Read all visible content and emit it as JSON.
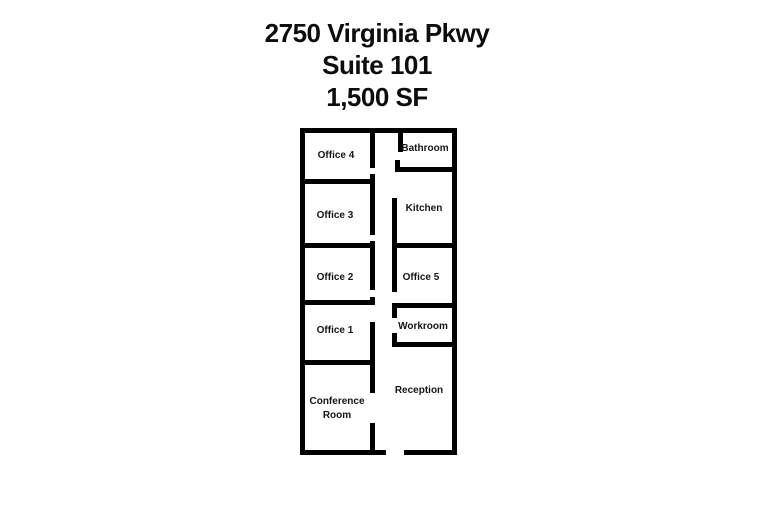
{
  "title": {
    "address": "2750 Virginia Pkwy",
    "suite": "Suite 101",
    "area": "1,500 SF"
  },
  "colors": {
    "wall": "#000000",
    "label_text": "#161616",
    "background": "#ffffff"
  },
  "floorplan": {
    "rooms": [
      {
        "name": "office-4",
        "label": "Office 4",
        "cx": 336,
        "cy": 156
      },
      {
        "name": "bathroom",
        "label": "Bathroom",
        "cx": 425,
        "cy": 149
      },
      {
        "name": "office-3",
        "label": "Office 3",
        "cx": 335,
        "cy": 216
      },
      {
        "name": "kitchen",
        "label": "Kitchen",
        "cx": 424,
        "cy": 209
      },
      {
        "name": "office-2",
        "label": "Office 2",
        "cx": 335,
        "cy": 278
      },
      {
        "name": "office-5",
        "label": "Office 5",
        "cx": 421,
        "cy": 278
      },
      {
        "name": "office-1",
        "label": "Office 1",
        "cx": 335,
        "cy": 331
      },
      {
        "name": "workroom",
        "label": "Workroom",
        "cx": 423,
        "cy": 327
      },
      {
        "name": "conference-room",
        "label": "Conference Room",
        "cx": 337,
        "cy": 409,
        "wrap_width": 70
      },
      {
        "name": "reception",
        "label": "Reception",
        "cx": 419,
        "cy": 391
      }
    ],
    "walls": [
      {
        "name": "outer-top",
        "x": 300,
        "y": 128,
        "w": 157,
        "h": 5
      },
      {
        "name": "outer-left",
        "x": 300,
        "y": 128,
        "w": 5,
        "h": 327
      },
      {
        "name": "outer-right",
        "x": 452,
        "y": 128,
        "w": 5,
        "h": 327
      },
      {
        "name": "outer-bottom-left",
        "x": 300,
        "y": 450,
        "w": 86,
        "h": 5
      },
      {
        "name": "outer-bottom-right",
        "x": 404,
        "y": 450,
        "w": 53,
        "h": 5
      },
      {
        "name": "office4-right",
        "x": 370,
        "y": 128,
        "w": 5,
        "h": 40
      },
      {
        "name": "office4-door-stub",
        "x": 370,
        "y": 174,
        "w": 5,
        "h": 10
      },
      {
        "name": "office3-top",
        "x": 300,
        "y": 179,
        "w": 75,
        "h": 5
      },
      {
        "name": "office3-right",
        "x": 370,
        "y": 184,
        "w": 5,
        "h": 51
      },
      {
        "name": "office3-door-stub",
        "x": 370,
        "y": 241,
        "w": 5,
        "h": 7
      },
      {
        "name": "office2-top",
        "x": 300,
        "y": 243,
        "w": 75,
        "h": 5
      },
      {
        "name": "office2-right",
        "x": 370,
        "y": 248,
        "w": 5,
        "h": 42
      },
      {
        "name": "office2-door-stub",
        "x": 370,
        "y": 297,
        "w": 5,
        "h": 8
      },
      {
        "name": "office1-top",
        "x": 300,
        "y": 300,
        "w": 75,
        "h": 5
      },
      {
        "name": "office1-right",
        "x": 370,
        "y": 322,
        "w": 5,
        "h": 71
      },
      {
        "name": "conference-top",
        "x": 300,
        "y": 360,
        "w": 75,
        "h": 5
      },
      {
        "name": "reception-left-stub",
        "x": 370,
        "y": 423,
        "w": 5,
        "h": 32
      },
      {
        "name": "bathroom-left",
        "x": 398,
        "y": 128,
        "w": 5,
        "h": 24
      },
      {
        "name": "bathroom-door-stub",
        "x": 395,
        "y": 160,
        "w": 5,
        "h": 12
      },
      {
        "name": "bathroom-bottom",
        "x": 395,
        "y": 167,
        "w": 62,
        "h": 5
      },
      {
        "name": "kitchen-left",
        "x": 392,
        "y": 198,
        "w": 5,
        "h": 50
      },
      {
        "name": "kitchen-bottom",
        "x": 392,
        "y": 243,
        "w": 65,
        "h": 5
      },
      {
        "name": "office5-left",
        "x": 392,
        "y": 248,
        "w": 5,
        "h": 44
      },
      {
        "name": "workroom-top",
        "x": 392,
        "y": 303,
        "w": 65,
        "h": 5
      },
      {
        "name": "workroom-left-upper",
        "x": 392,
        "y": 303,
        "w": 5,
        "h": 15
      },
      {
        "name": "workroom-left-lower",
        "x": 392,
        "y": 333,
        "w": 5,
        "h": 14
      },
      {
        "name": "workroom-bottom",
        "x": 392,
        "y": 342,
        "w": 65,
        "h": 5
      }
    ]
  }
}
